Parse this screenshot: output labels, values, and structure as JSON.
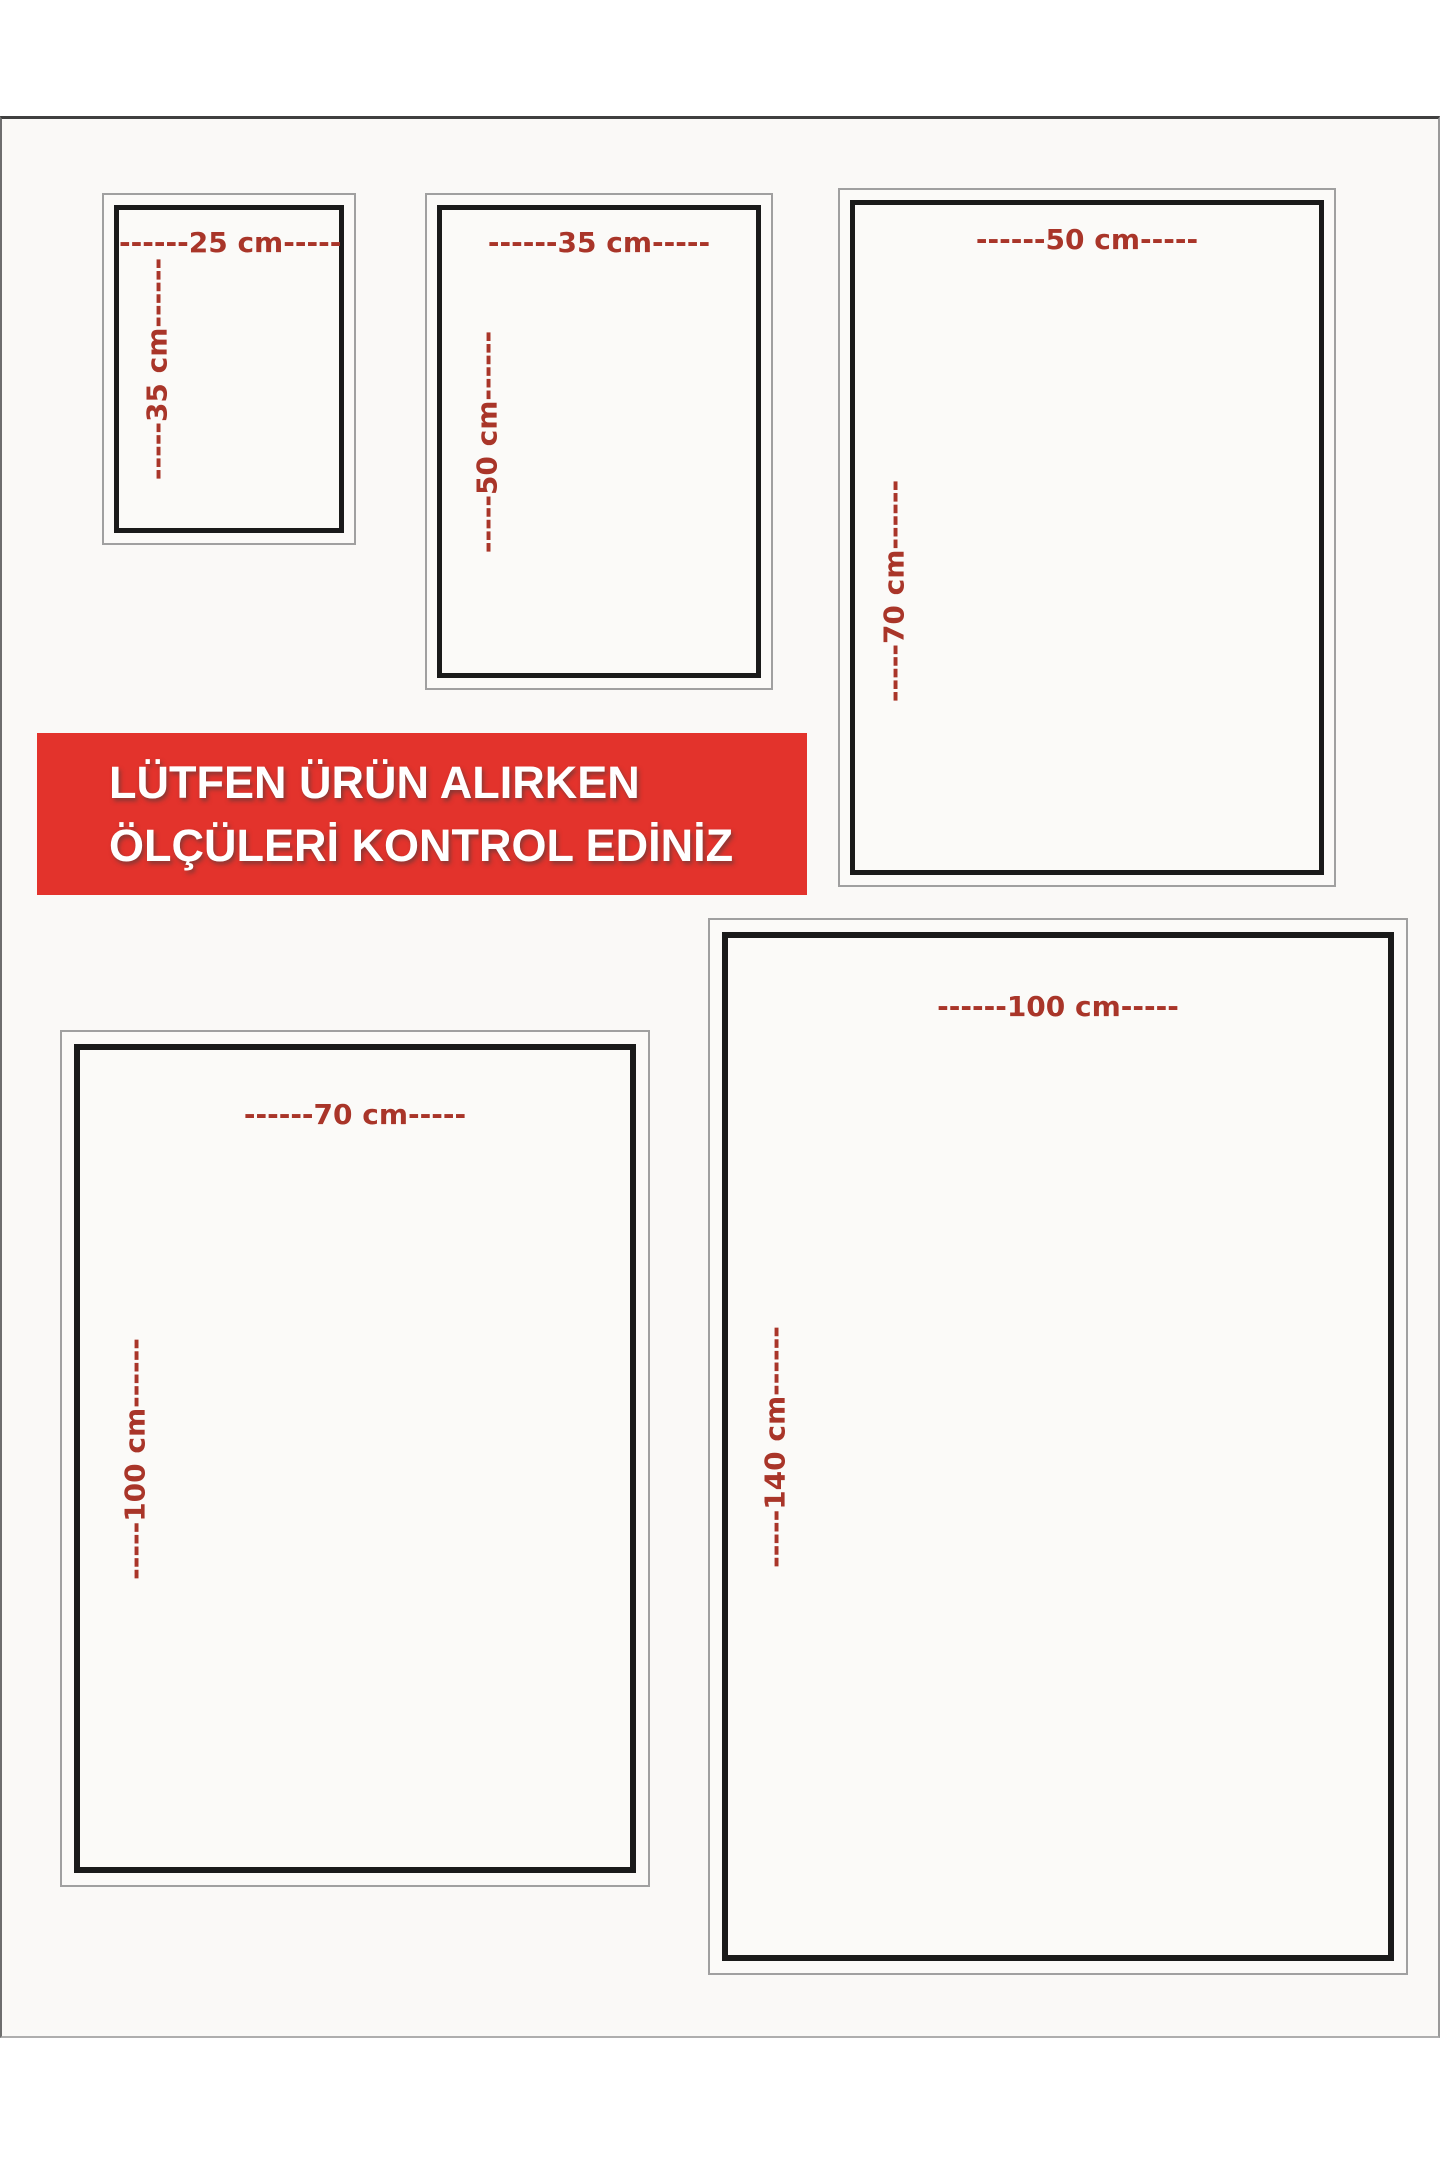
{
  "notice": {
    "line1": "LÜTFEN ÜRÜN ALIRKEN",
    "line2": "ÖLÇÜLERİ KONTROL EDİNİZ"
  },
  "sizes": [
    {
      "id": "25x35",
      "width_cm": 25,
      "height_cm": 35,
      "width_label": "------25 cm-----",
      "height_label": "-----35 cm------"
    },
    {
      "id": "35x50",
      "width_cm": 35,
      "height_cm": 50,
      "width_label": "------35 cm-----",
      "height_label": "-----50 cm------"
    },
    {
      "id": "50x70",
      "width_cm": 50,
      "height_cm": 70,
      "width_label": "------50 cm-----",
      "height_label": "-----70 cm------"
    },
    {
      "id": "70x100",
      "width_cm": 70,
      "height_cm": 100,
      "width_label": "------70 cm-----",
      "height_label": "-----100 cm------"
    },
    {
      "id": "100x140",
      "width_cm": 100,
      "height_cm": 140,
      "width_label": "------100 cm-----",
      "height_label": "-----140 cm------"
    }
  ],
  "colors": {
    "banner_bg": "#e3332c",
    "banner_text": "#ffffff",
    "dimension_text": "#a93529",
    "panel_border": "#1a1a1a",
    "frame_border": "#a0a0a0",
    "card_bg": "#faf9f7"
  }
}
